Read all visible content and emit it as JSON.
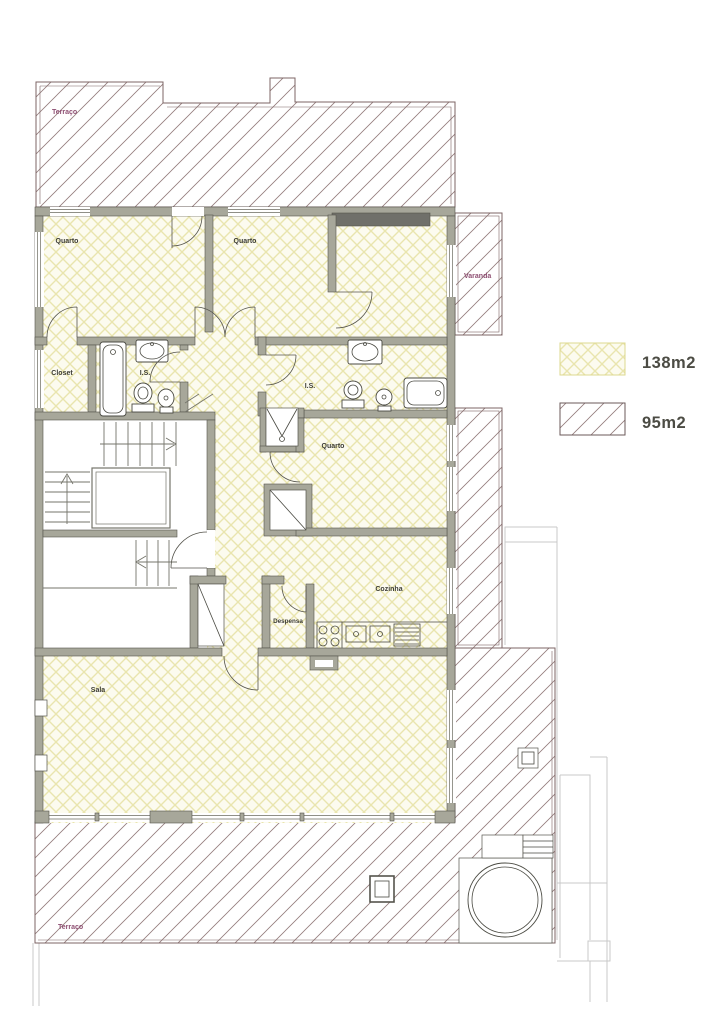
{
  "drawing": {
    "type": "architectural-floor-plan",
    "labels": {
      "terrace_top": "Terraço",
      "bedroom_1": "Quarto",
      "bedroom_2": "Quarto",
      "closet": "Closet",
      "bathroom_1": "I.S.",
      "balcony": "Varanda",
      "bathroom_2": "I.S.",
      "bedroom_3": "Quarto",
      "kitchen": "Cozinha",
      "pantry": "Despensa",
      "living_room": "Sala",
      "terrace_bottom": "Terraço"
    },
    "legend": [
      {
        "pattern": "yellow-crosshatch",
        "label": "138m2"
      },
      {
        "pattern": "diagonal-hatch",
        "label": "95m2"
      }
    ],
    "colors": {
      "apartment_fill": "#fcfbef",
      "apartment_hatch": "#e9e5ae",
      "terrace_hatch": "#947c7c",
      "terrace_line": "#7c6464",
      "wall_fill": "#a7a79a",
      "wall_edge": "#55544c",
      "wall_dark": "#70706a",
      "terrace_label": "#8e4f72",
      "room_label": "#3c3c34",
      "legend_text": "#4c4c44",
      "faint_outline": "#c9c9c9"
    }
  }
}
